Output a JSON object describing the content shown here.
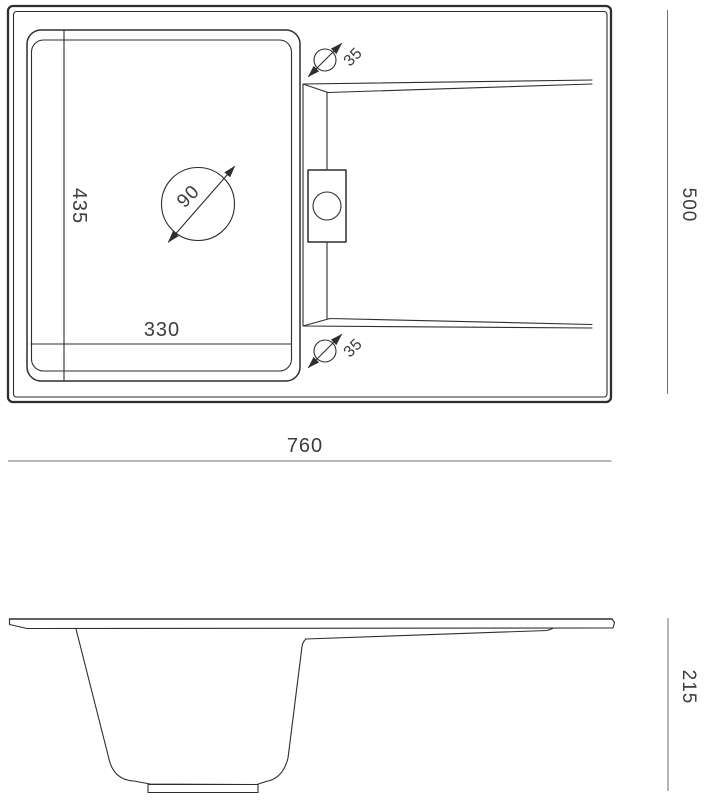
{
  "drawing": {
    "type": "sink-technical-drawing",
    "colors": {
      "line": "#2e2e2e",
      "dimension_line": "#6f6f6f",
      "text": "#3c3c3c",
      "background": "#ffffff"
    },
    "top_view": {
      "overall_width": "760",
      "overall_depth": "500",
      "bowl_width": "330",
      "bowl_depth": "435",
      "drain_diameter": "90",
      "tap_hole_top_diameter": "35",
      "tap_hole_bottom_diameter": "35"
    },
    "side_view": {
      "height": "215"
    }
  }
}
